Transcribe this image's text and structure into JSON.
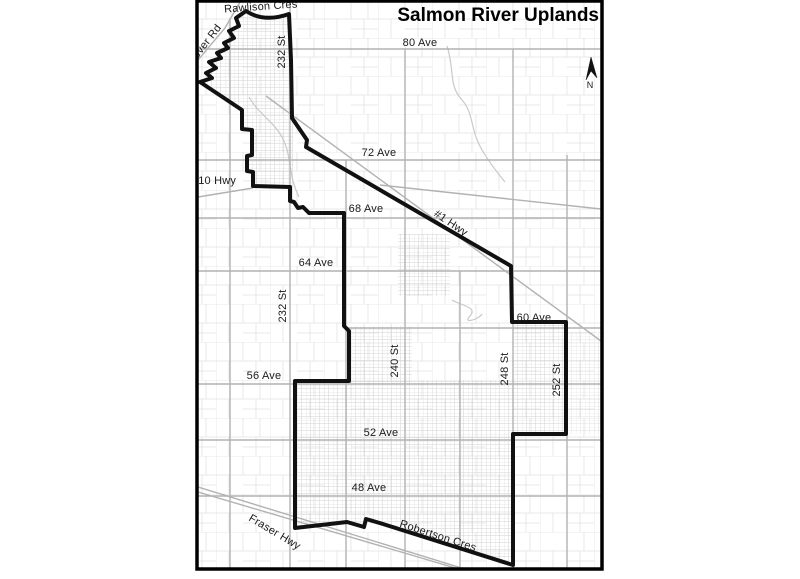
{
  "map": {
    "title": "Salmon River Uplands",
    "north_label": "N",
    "colors": {
      "boundary": "#111111",
      "road": "#b2b2b2",
      "parcel_line": "#e2e2e2",
      "label_text": "#1a1a1a",
      "background": "#ffffff"
    },
    "road_labels": [
      {
        "id": "rawlison-cres",
        "text": "Rawlison Cres"
      },
      {
        "id": "glover-rd",
        "text": "Glover Rd"
      },
      {
        "id": "232-st-north",
        "text": "232 St"
      },
      {
        "id": "80-ave",
        "text": "80 Ave"
      },
      {
        "id": "72-ave",
        "text": "72 Ave"
      },
      {
        "id": "10-hwy",
        "text": "#10 Hwy"
      },
      {
        "id": "68-ave",
        "text": "68 Ave"
      },
      {
        "id": "1-hwy",
        "text": "#1 Hwy"
      },
      {
        "id": "64-ave",
        "text": "64 Ave"
      },
      {
        "id": "232-st-south",
        "text": "232 St"
      },
      {
        "id": "60-ave",
        "text": "60 Ave"
      },
      {
        "id": "240-st",
        "text": "240 St"
      },
      {
        "id": "248-st",
        "text": "248 St"
      },
      {
        "id": "252-st",
        "text": "252 St"
      },
      {
        "id": "56-ave",
        "text": "56 Ave"
      },
      {
        "id": "52-ave",
        "text": "52 Ave"
      },
      {
        "id": "48-ave",
        "text": "48 Ave"
      },
      {
        "id": "fraser-hwy",
        "text": "Fraser Hwy"
      },
      {
        "id": "robertson-cres",
        "text": "Robertson Cres"
      }
    ]
  }
}
